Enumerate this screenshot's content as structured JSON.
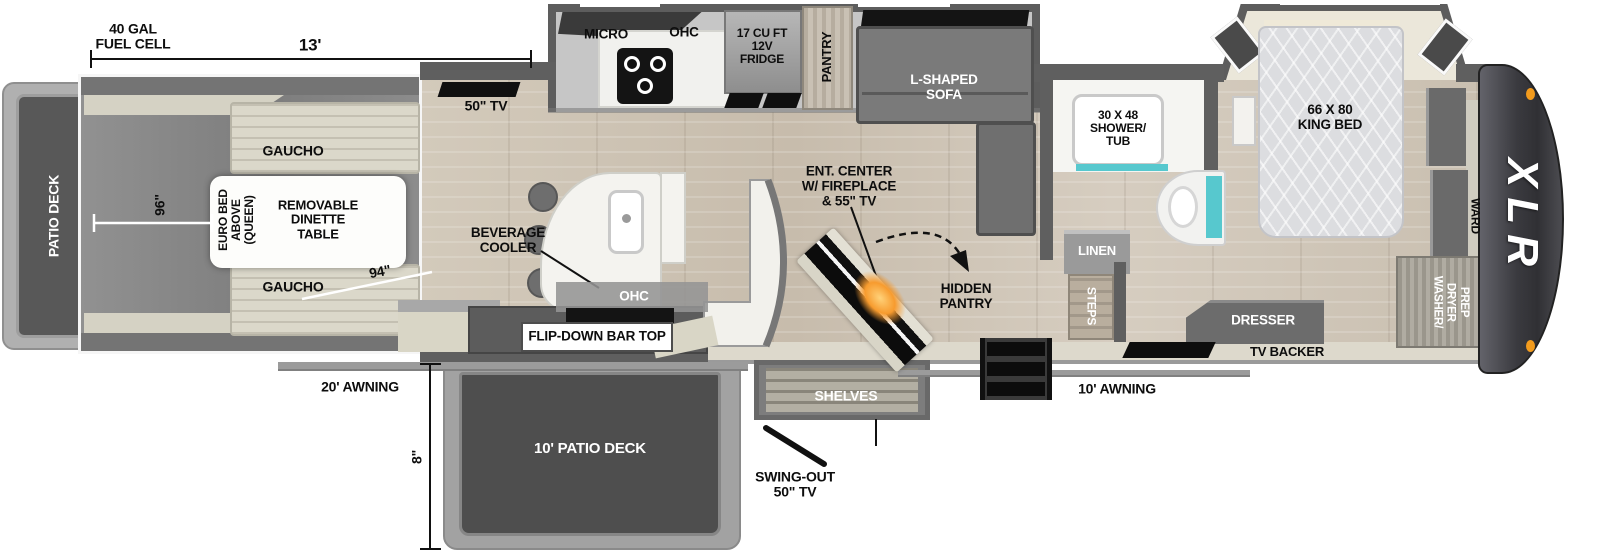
{
  "plan": {
    "brand": "XLR",
    "rear": {
      "patio_deck": "PATIO DECK",
      "fuel_cell": "40 GAL\nFUEL CELL"
    },
    "dimensions": {
      "length_13": "13'",
      "width_96": "96\"",
      "diag_94": "94\"",
      "drop_8": "8\""
    },
    "garage": {
      "tv": "50\" TV",
      "gaucho_top": "GAUCHO",
      "gaucho_bottom": "GAUCHO",
      "euro_bed": "EURO BED\nABOVE\n(QUEEN)",
      "dinette": "REMOVABLE\nDINETTE\nTABLE"
    },
    "kitchen": {
      "micro": "MICRO",
      "ohc": "OHC",
      "fridge": "17 CU FT\n12V\nFRIDGE",
      "pantry": "PANTRY",
      "island_ohc": "OHC",
      "beverage_cooler": "BEVERAGE\nCOOLER",
      "flip_bar": "FLIP-DOWN BAR TOP"
    },
    "living": {
      "sofa": "L-SHAPED\nSOFA",
      "ent_center": "ENT. CENTER\nW/ FIREPLACE\n& 55\" TV",
      "hidden_pantry": "HIDDEN\nPANTRY"
    },
    "bath": {
      "shower": "30 X 48\nSHOWER/\nTUB",
      "linen": "LINEN",
      "steps": "STEPS"
    },
    "bedroom": {
      "bed": "66 X 80\nKING BED",
      "dresser": "DRESSER",
      "tv_backer": "TV BACKER",
      "ward": "WARD",
      "washer_prep": "WASHER/\nDRYER\nPREP"
    },
    "exterior": {
      "awning_20": "20' AWNING",
      "awning_10": "10' AWNING",
      "patio_deck_10": "10' PATIO DECK",
      "shelves": "SHELVES",
      "swing_tv": "SWING-OUT\n50\" TV"
    },
    "colors": {
      "teal": "#57c8ce",
      "flame": "#f79b2e",
      "marker_light": "#f29b1d"
    }
  }
}
